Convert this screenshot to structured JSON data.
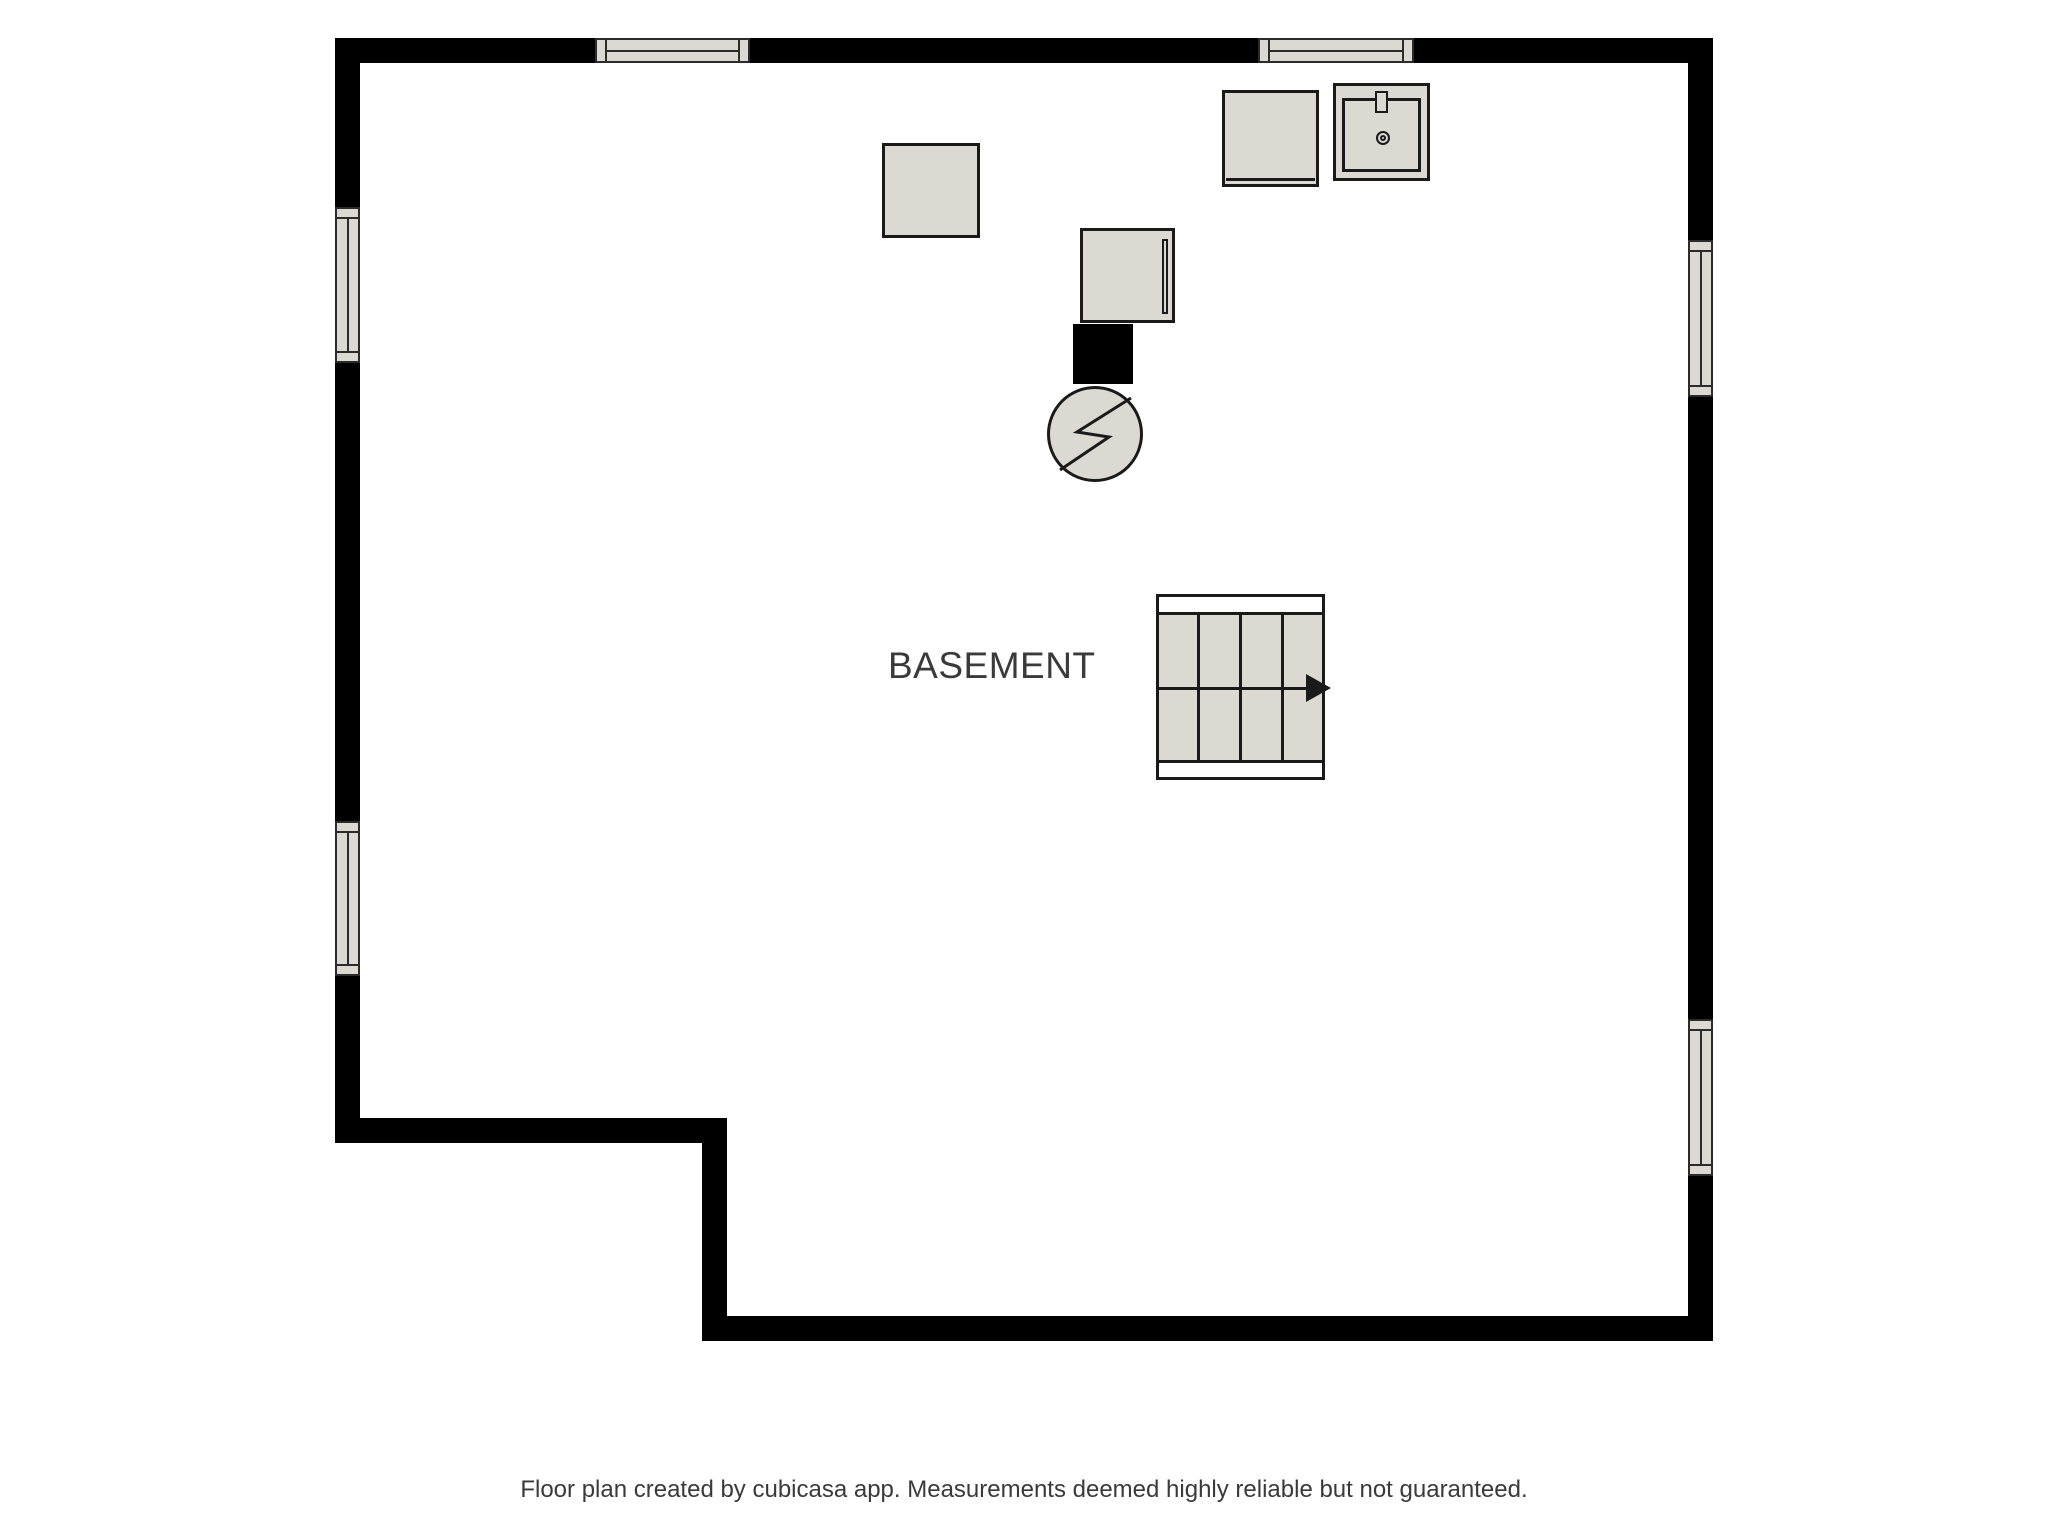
{
  "colors": {
    "background": "#ffffff",
    "wall": "#000000",
    "fixture_fill": "#dcd9d3",
    "outline": "#1a1a1a",
    "text": "#3a3a3a"
  },
  "rooms": [
    {
      "label": "BASEMENT"
    }
  ],
  "windows": {
    "top_wall": 2,
    "left_wall": 2,
    "right_wall": 2
  },
  "fixtures": [
    {
      "name": "storage-box"
    },
    {
      "name": "furnace"
    },
    {
      "name": "flue"
    },
    {
      "name": "water-heater",
      "icon": "lightning-bolt-icon"
    },
    {
      "name": "washer"
    },
    {
      "name": "utility-sink",
      "details": [
        "faucet",
        "drain"
      ]
    },
    {
      "name": "staircase",
      "arrow_direction": "right",
      "tread_columns": 4,
      "flights": 2
    }
  ],
  "footer": {
    "caption": "Floor plan created by cubicasa app. Measurements deemed highly reliable but not guaranteed."
  }
}
